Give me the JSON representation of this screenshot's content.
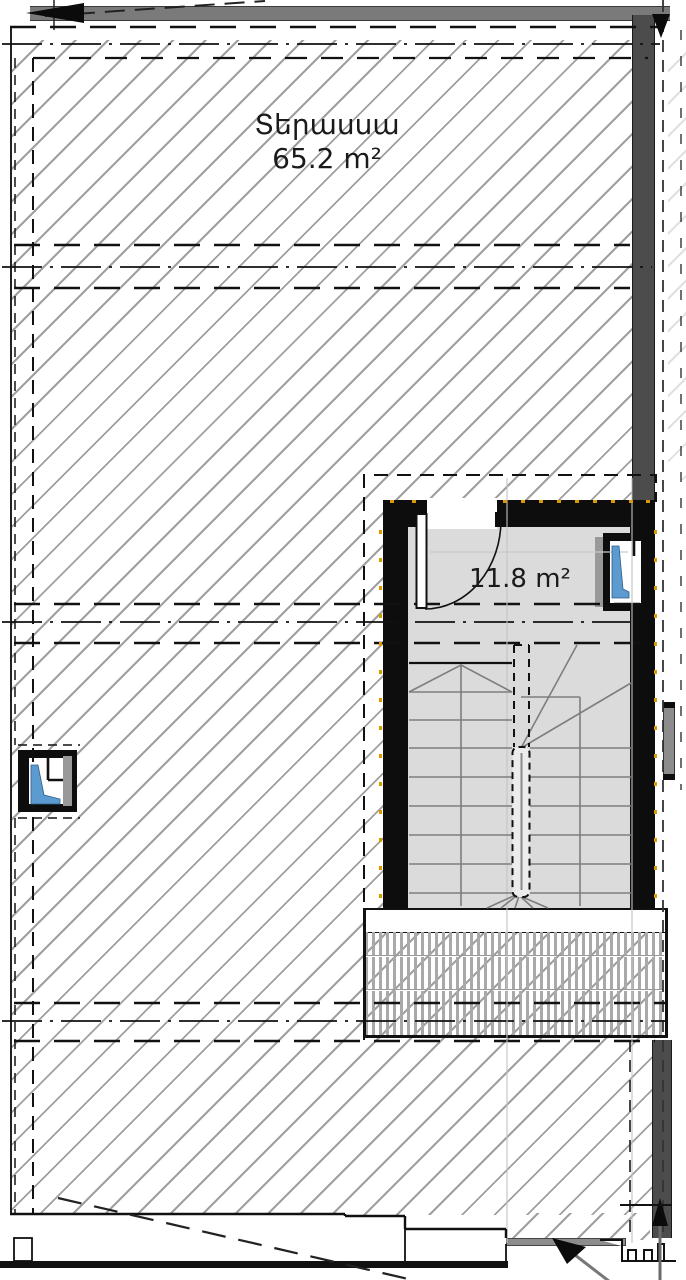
{
  "drawing": {
    "type": "architectural floor plan",
    "rooms": [
      {
        "id": "terrace",
        "label": "Տերասսա",
        "area": "65.2 m²"
      },
      {
        "id": "stairwell",
        "label": "",
        "area": "11.8 m²"
      }
    ]
  },
  "colors": {
    "hatch_line": "#9f9f9f",
    "wall_black": "#0d0d0d",
    "room_fill": "#dbdbdb",
    "concrete_gray": "#4c4c4c",
    "parapet_gray": "#7a7a7a",
    "stair_line": "#7e7e7e",
    "glass_blue": "#5b9bd0",
    "insulation_marker_orange": "#d89b00"
  }
}
